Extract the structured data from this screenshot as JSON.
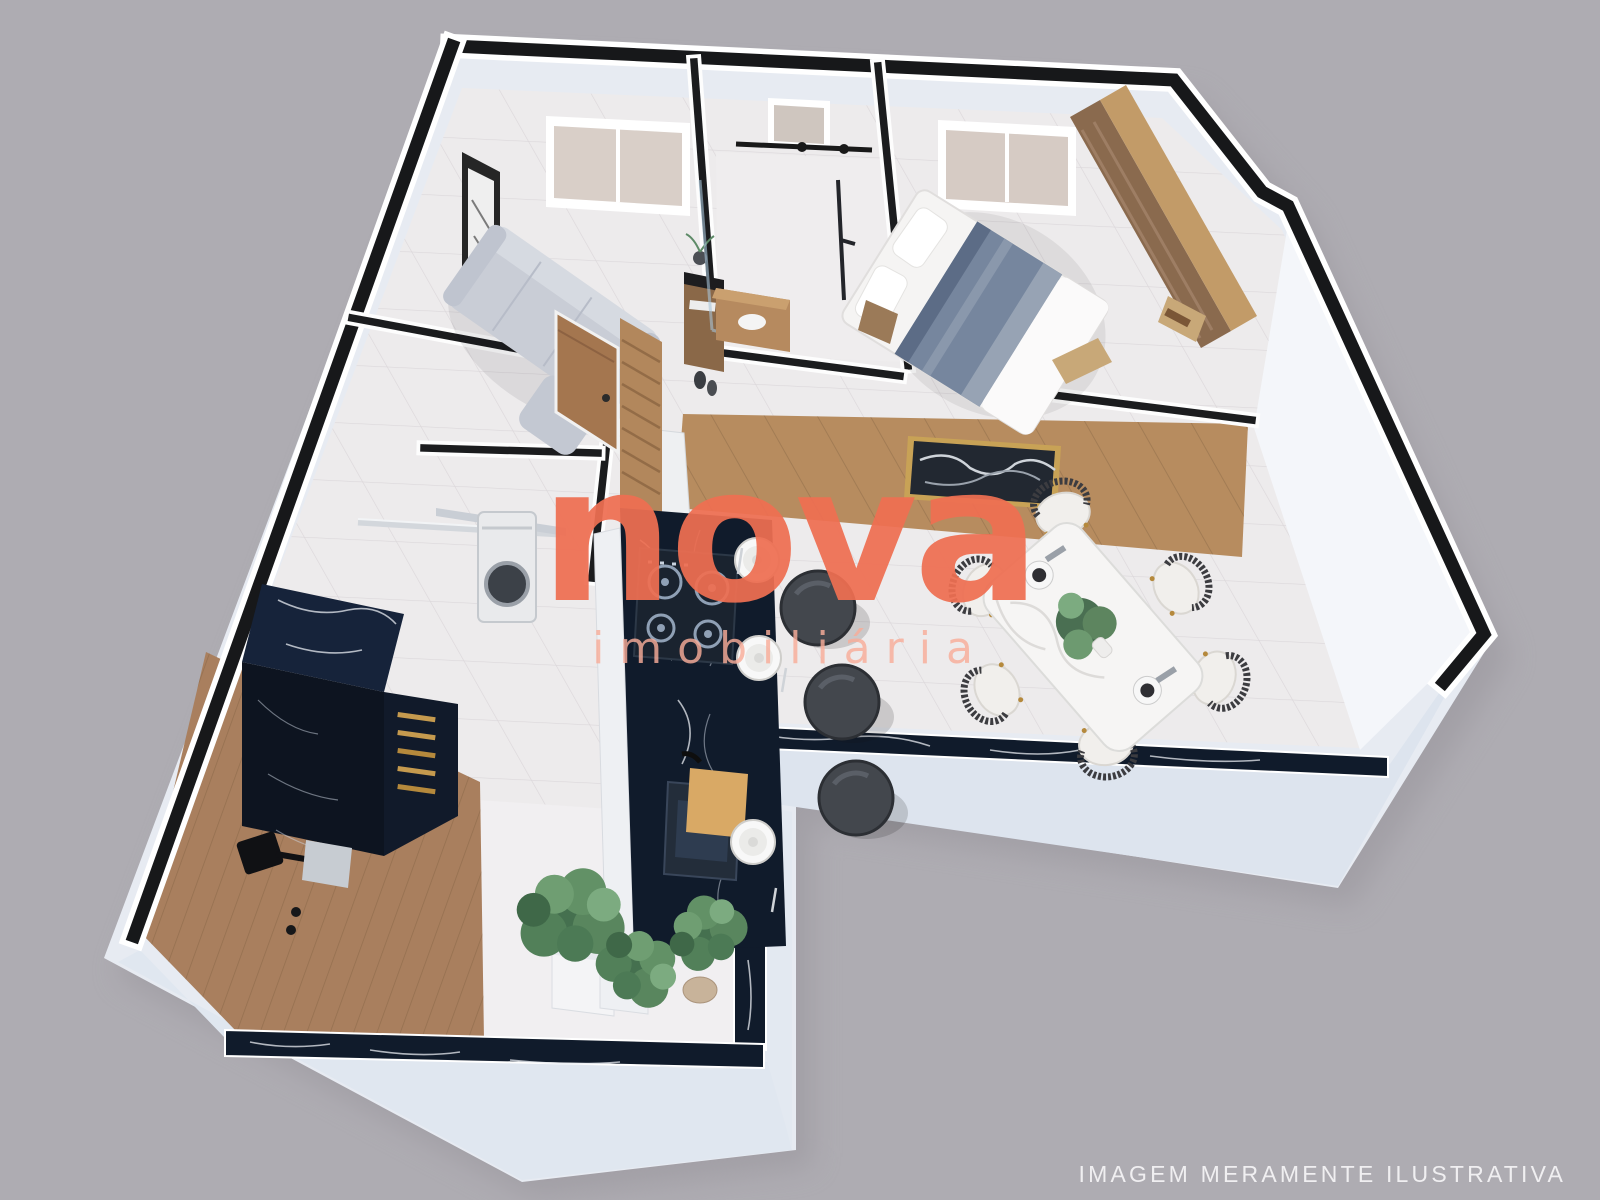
{
  "scene": {
    "type": "3d-isometric-floor-plan-rendering",
    "elements": [
      "living-room",
      "entry-hall",
      "bathroom",
      "bedroom",
      "kitchen",
      "dining-area",
      "laundry-area",
      "terrace-deck",
      "balcony-parapet",
      "potted-plants"
    ]
  },
  "watermark": {
    "brand": "nova",
    "subtitle": "imobiliária"
  },
  "footer": {
    "disclaimer": "IMAGEM MERAMENTE ILUSTRATIVA"
  },
  "colors": {
    "bg": "#aeacb2",
    "brand": "#ef6f52",
    "subtitle": "rgba(248,172,152,0.82)",
    "caption": "#f4f3f5",
    "wall-cut": "#17181a",
    "wall-white": "#ffffff",
    "floor-ivory": "#edebec",
    "marble-black": "#101b2b",
    "wood": "#b2875c",
    "sofa-gray": "#c9cdd6"
  }
}
